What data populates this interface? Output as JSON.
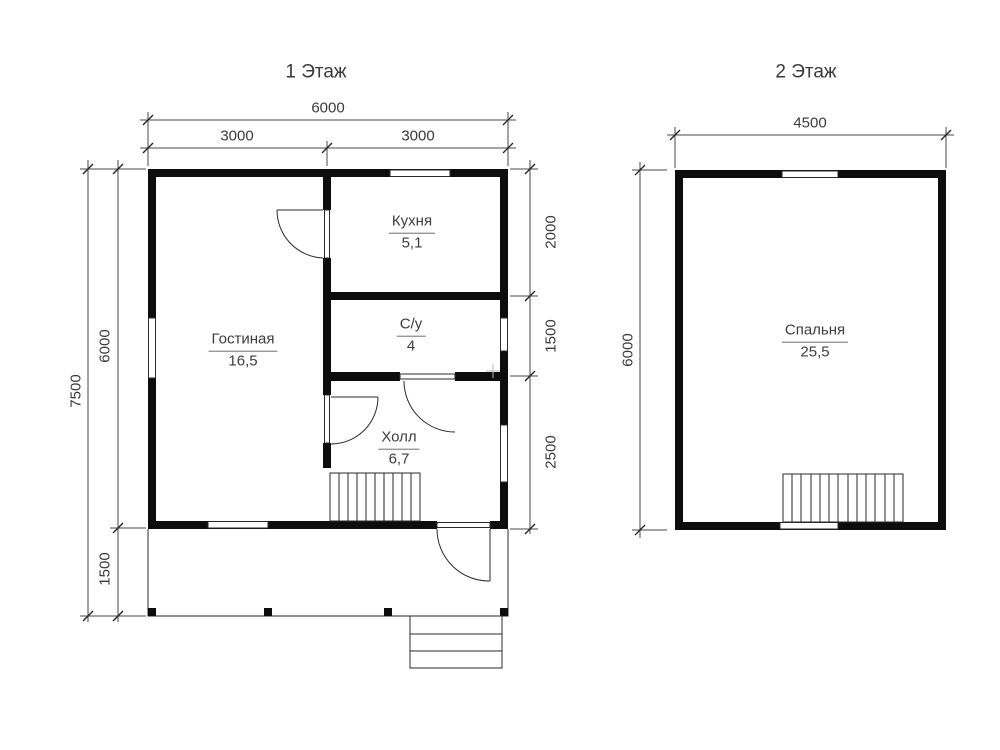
{
  "floor1": {
    "title": "1 Этаж",
    "dims": {
      "top_total": "6000",
      "top_left": "3000",
      "top_right": "3000",
      "side_total": "7500",
      "side_main": "6000",
      "side_porch": "1500",
      "right_kitchen": "2000",
      "right_wc": "1500",
      "right_hall": "2500"
    },
    "rooms": {
      "living": {
        "name": "Гостиная",
        "area": "16,5"
      },
      "kitchen": {
        "name": "Кухня",
        "area": "5,1"
      },
      "wc": {
        "name": "С/у",
        "area": "4"
      },
      "hall": {
        "name": "Холл",
        "area": "6,7"
      }
    }
  },
  "floor2": {
    "title": "2 Этаж",
    "dims": {
      "top_total": "4500",
      "side_total": "6000"
    },
    "rooms": {
      "bedroom": {
        "name": "Спальня",
        "area": "25,5"
      }
    }
  },
  "colors": {
    "wall": "#0d0d0d",
    "line": "#3c3c3c",
    "text": "#3a3a3a",
    "background": "#ffffff"
  }
}
